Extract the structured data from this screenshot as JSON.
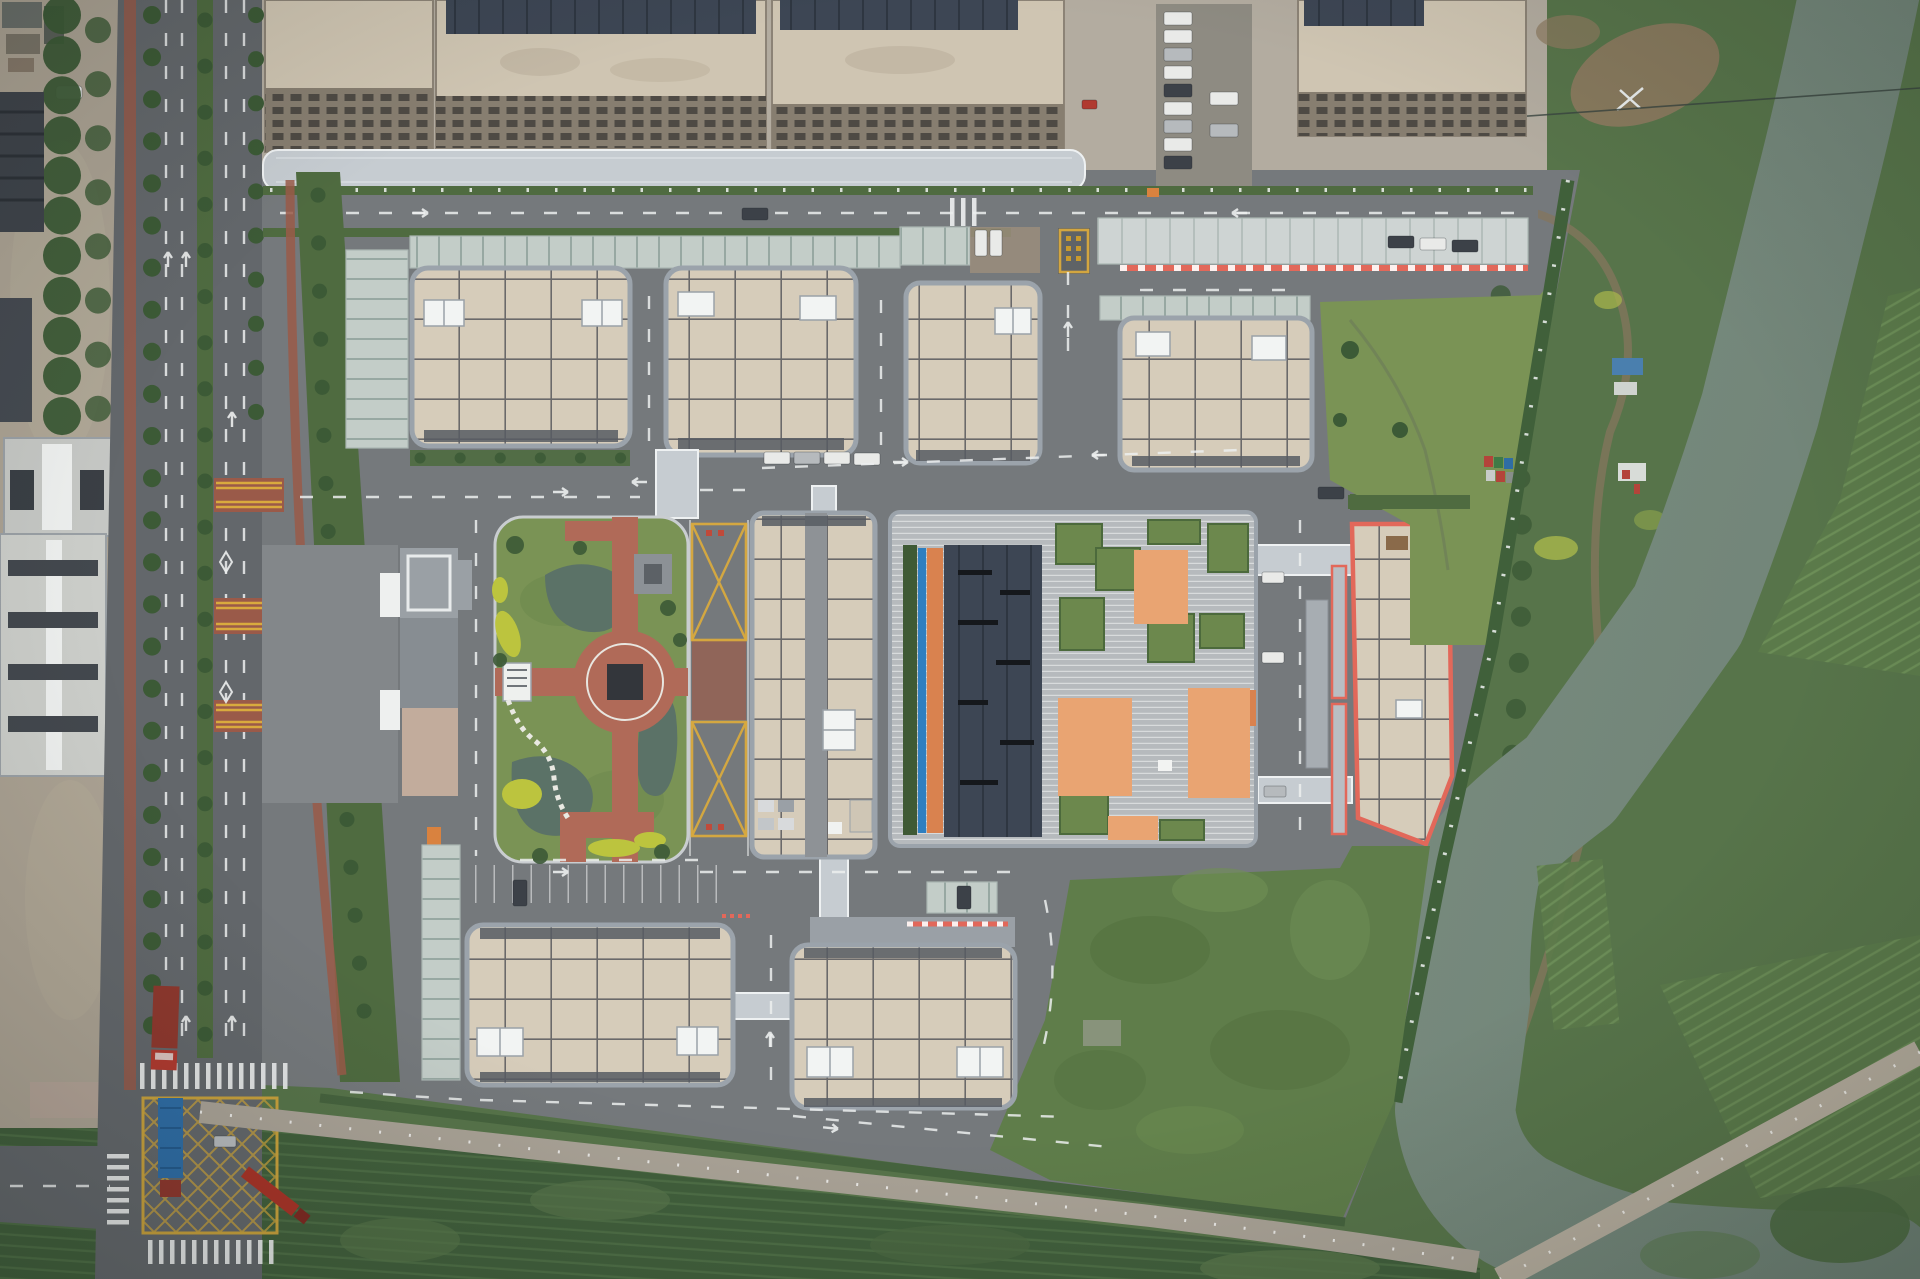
{
  "scene": {
    "type": "aerial-drone-photo",
    "description": "Top-down aerial photograph of an industrial business-park campus: four grid-roof factory buildings along the north, a central landscaped garden with a circular brick plaza and ponds, a green-roof building with orange tile patches, a red-outlined trapezoidal building by the east boundary, two factory buildings at the south, covered walkways, glass carports, a tree-lined avenue with trucks and a yellow box junction on the west, and a gray-green river with dense vegetation and field plots on the east.",
    "palette": {
      "asphalt": "#75797c",
      "avenue": "#63676b",
      "pave": "#b3aca0",
      "gravel": "#aba293",
      "dirt": "#8d7a5f",
      "roof-beige": "#d6ccba",
      "roof-beige2": "#cfc5b2",
      "roof-line": "#45484e",
      "parapet": "#9ba3ab",
      "roof-navy": "#3d4654",
      "corridor": "#c6ccd1",
      "canopy": "#c3cdc8",
      "canopy-line": "#97a8a2",
      "hedge": "#4f6b40",
      "lawn": "#7a9355",
      "lawn2": "#6c884d",
      "wild": "#5f7d4a",
      "veg": "#57744a",
      "tree": "#3c5a36",
      "field": "#415f3c",
      "fieldline": "#4e6e46",
      "water": "#76897c",
      "pond": "#5b7267",
      "brick": "#b06a58",
      "yellow": "#d9aa3e",
      "redline": "#e2685a",
      "orange-tile": "#e9a472",
      "orange": "#d9824f",
      "white-mark": "#eceeee",
      "truck-red": "#b03a30",
      "truck-dark-red": "#8e382e",
      "truck-blue": "#2f6da5",
      "digger": "#c9a23b",
      "shrub-yellow": "#bcc43e",
      "stripe-roof": "#b6babd",
      "window": "#4e4a44"
    },
    "counts": {
      "campus_grid_roof_buildings": 8,
      "no_parking_cross_boxes": 2,
      "container_trucks": 2,
      "flatbed_truck": 1,
      "excavator": 1,
      "speed_tables_on_avenue": 3,
      "box_junction": 1
    },
    "features": [
      "main-avenue-west",
      "tree-lined-median",
      "red-cycle-lanes",
      "box-junction",
      "container-trucks",
      "north-industrial-complex",
      "covered-walkway",
      "glass-carports",
      "entry-gate-yellow-marking",
      "grid-roof-buildings",
      "central-garden",
      "circular-brick-plaza",
      "ponds",
      "yellow-shrubs",
      "zigzag-path",
      "no-parking-x-boxes",
      "green-roof-building",
      "orange-tile-patches",
      "red-outlined-building",
      "covered-bridges",
      "south-building-row",
      "wild-grass-lot",
      "boundary-fence-posts",
      "river-east",
      "riverbank-vegetation",
      "field-plots",
      "dirt-tracks",
      "power-line"
    ]
  }
}
